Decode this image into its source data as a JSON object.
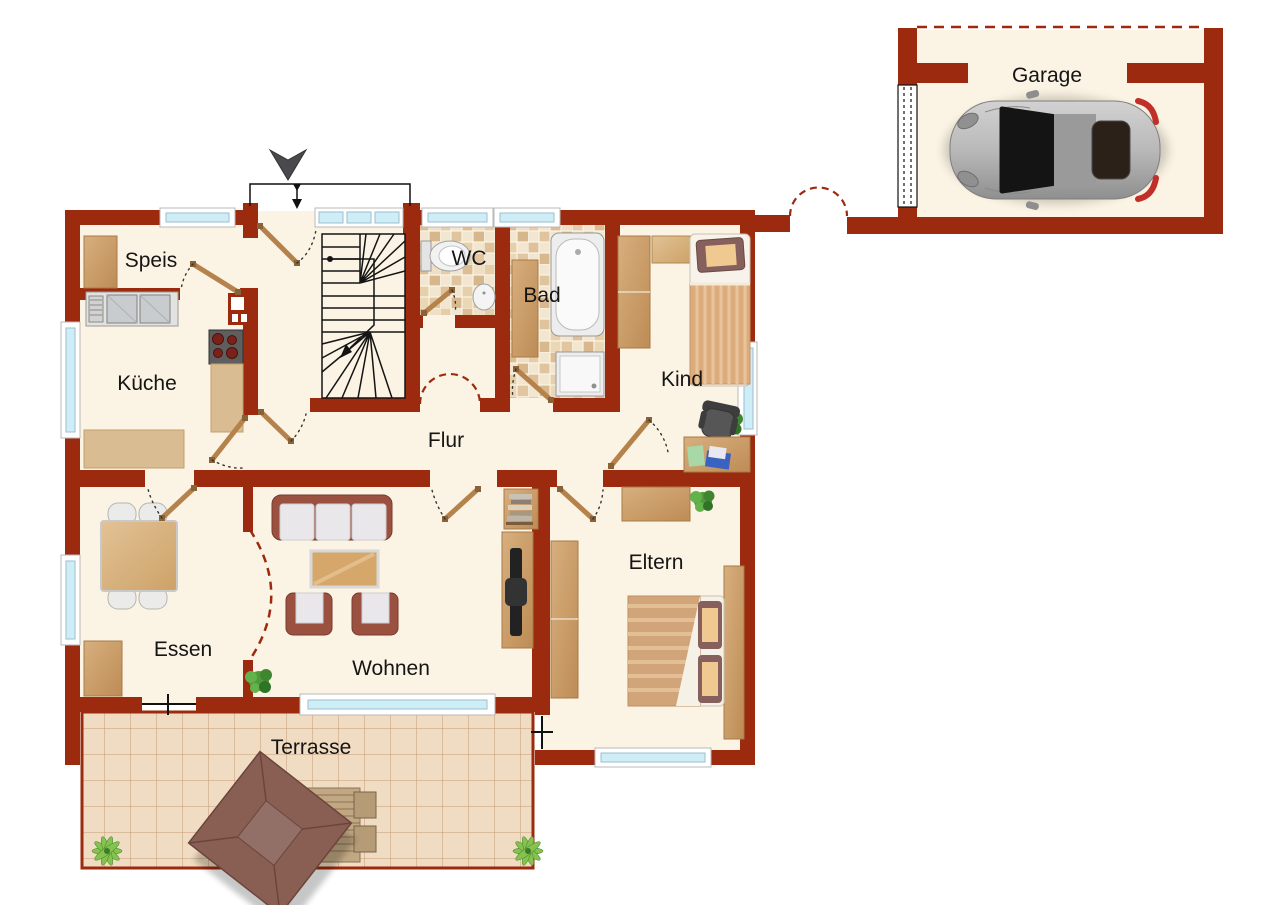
{
  "rooms": {
    "speis": {
      "label": "Speis"
    },
    "kueche": {
      "label": "Küche"
    },
    "wc": {
      "label": "WC"
    },
    "bad": {
      "label": "Bad"
    },
    "kind": {
      "label": "Kind"
    },
    "flur": {
      "label": "Flur"
    },
    "essen": {
      "label": "Essen"
    },
    "wohnen": {
      "label": "Wohnen"
    },
    "eltern": {
      "label": "Eltern"
    },
    "terrasse": {
      "label": "Terrasse"
    },
    "garage": {
      "label": "Garage"
    }
  },
  "colors": {
    "wall": "#9C2A0E",
    "floor": "#FBF3E3",
    "window_pane": "#CDEEF7",
    "tile_base": "#F2E6D0",
    "terrace_tile": "#EFDCC2",
    "door_leaf": "#B5824C",
    "sofa": "#9A5140",
    "plant": "#4F9B3C"
  }
}
